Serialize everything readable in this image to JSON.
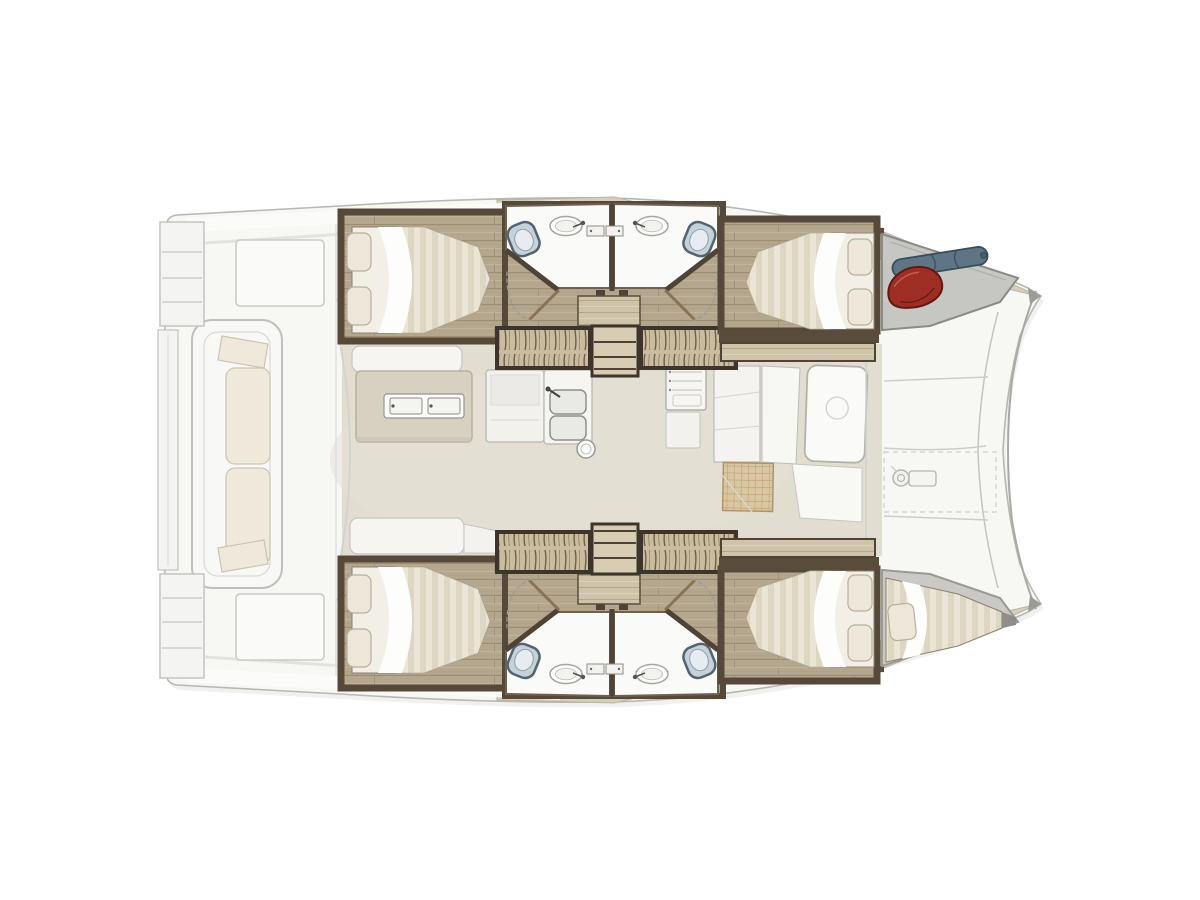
{
  "app": {
    "title": "Catamaran interior layout plan",
    "orientation": "bow-right",
    "background": "#ffffff"
  },
  "palette": {
    "hull_white": "#f7f7f4",
    "hull_outline": "#b7b7b3",
    "side_deck_teak": "#d5cebd",
    "wall_dark_wood": "#57493a",
    "cabin_floor_wood": "#b4a78d",
    "steps_wood": "#cbbea1",
    "bed_linen": "#eae5d4",
    "bed_stripe": "#ddd6c2",
    "pillow": "#ece7d9",
    "bathroom_floor": "#fafaf8",
    "toilet_blue_gray": "#c6d2da",
    "salon_floor": "#e1ddd0",
    "island_beige": "#d7d1c2",
    "mat_rattan": "#d9c7a2",
    "gear_bag_red": "#9e2d23",
    "gear_roll_blue": "#5d7585",
    "locker_gray": "#c6c6c2"
  },
  "plan": {
    "vessel": {
      "label": "Catamaran floor plan, bow to the right"
    },
    "regions": {
      "transom_steps": {
        "label": "Transom steps"
      },
      "cockpit": {
        "label": "Aft cockpit with bench sofa"
      },
      "cockpit_bench": {
        "label": "Cockpit bench with cushions"
      },
      "salon": {
        "label": "Main salon"
      },
      "galley_island": {
        "label": "Galley island with two-burner cooktop"
      },
      "galley_counter": {
        "label": "Galley counter"
      },
      "galley_sink": {
        "label": "Double galley sink"
      },
      "galley_appliance": {
        "label": "Galley oven unit"
      },
      "dinette": {
        "label": "Forward dinette with table and rattan mat"
      },
      "foredeck": {
        "label": "Foredeck with anchor windlass"
      },
      "windlass": {
        "label": "Anchor windlass"
      },
      "starboard_aft_cabin": {
        "label": "Aft double cabin, upper hull"
      },
      "starboard_fwd_cabin": {
        "label": "Forward double cabin, upper hull"
      },
      "port_aft_cabin": {
        "label": "Aft double cabin, lower hull"
      },
      "port_fwd_cabin": {
        "label": "Forward double cabin, lower hull"
      },
      "head": {
        "label": "Head with toilet and washbasin",
        "count": 4
      },
      "companionway": {
        "label": "Companionway steps to hull"
      },
      "bow_locker": {
        "label": "Bow locker with stowed gear"
      },
      "forepeak_berth": {
        "label": "Forepeak single berth"
      }
    },
    "objects": {
      "red_bag": {
        "label": "Red gear bag",
        "color": "#9e2d23"
      },
      "gear_roll": {
        "label": "Rolled gray-blue gear",
        "color": "#5d7585"
      },
      "toilet": {
        "label": "Marine toilet"
      },
      "washbasin": {
        "label": "Washbasin with faucet"
      },
      "double_bed": {
        "label": "Double berth with two pillows",
        "count": 4
      }
    }
  }
}
